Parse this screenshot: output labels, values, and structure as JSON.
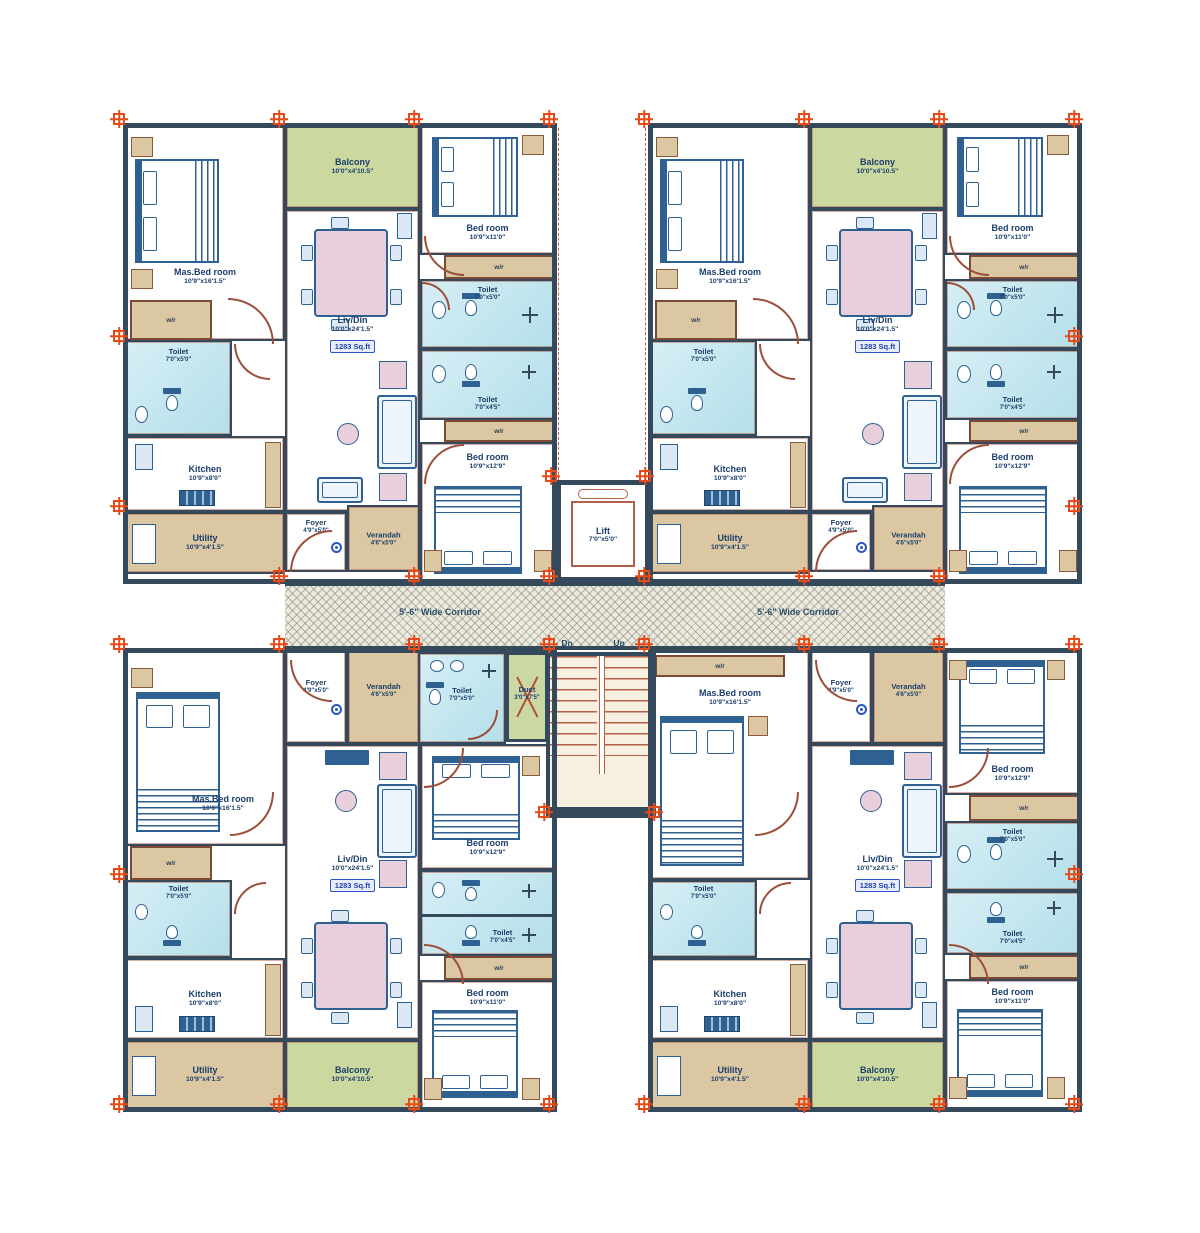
{
  "plan": {
    "corridor_label": "5'-6\" Wide Corridor",
    "stairs": {
      "down_label": "Dn",
      "up_label": "Up"
    },
    "lift": {
      "name": "Lift",
      "dims": "7'0\"x5'0\""
    },
    "duct": {
      "name": "Duct",
      "dims": "3'0\"x7'5\""
    },
    "rooms": {
      "master_bedroom": {
        "name": "Mas.Bed room",
        "dims": "10'9\"x16'1.5\""
      },
      "bedroom_11": {
        "name": "Bed room",
        "dims": "10'9\"x11'0\""
      },
      "bedroom_129": {
        "name": "Bed room",
        "dims": "10'9\"x12'9\""
      },
      "living_dining": {
        "name": "Liv/Din",
        "dims": "10'0\"x24'1.5\"",
        "area_label": "1283 Sq.ft"
      },
      "kitchen": {
        "name": "Kitchen",
        "dims": "10'9\"x8'0\""
      },
      "utility": {
        "name": "Utility",
        "dims": "10'9\"x4'1.5\""
      },
      "balcony": {
        "name": "Balcony",
        "dims": "10'0\"x4'10.5\""
      },
      "foyer": {
        "name": "Foyer",
        "dims": "4'9\"x5'0\""
      },
      "verandah": {
        "name": "Verandah",
        "dims": "4'6\"x5'0\""
      },
      "toilet_50": {
        "name": "Toilet",
        "dims": "7'0\"x5'0\""
      },
      "toilet_45": {
        "name": "Toilet",
        "dims": "7'0\"x4'5\""
      },
      "wardrobe_label": "w/r"
    },
    "colors": {
      "wall": "#35495c",
      "balcony_floor": "#cbd9a0",
      "toilet_floor": "#bfe3ed",
      "wood_floor": "#dbc7a2",
      "corridor_floor": "#edead9",
      "furniture": "#2e6091",
      "dining_pink": "#e9cedb",
      "label_text": "#1c3e6b",
      "area_box": "#2b54c9",
      "marker": "#e64a19",
      "door": "#9c4f38"
    }
  }
}
